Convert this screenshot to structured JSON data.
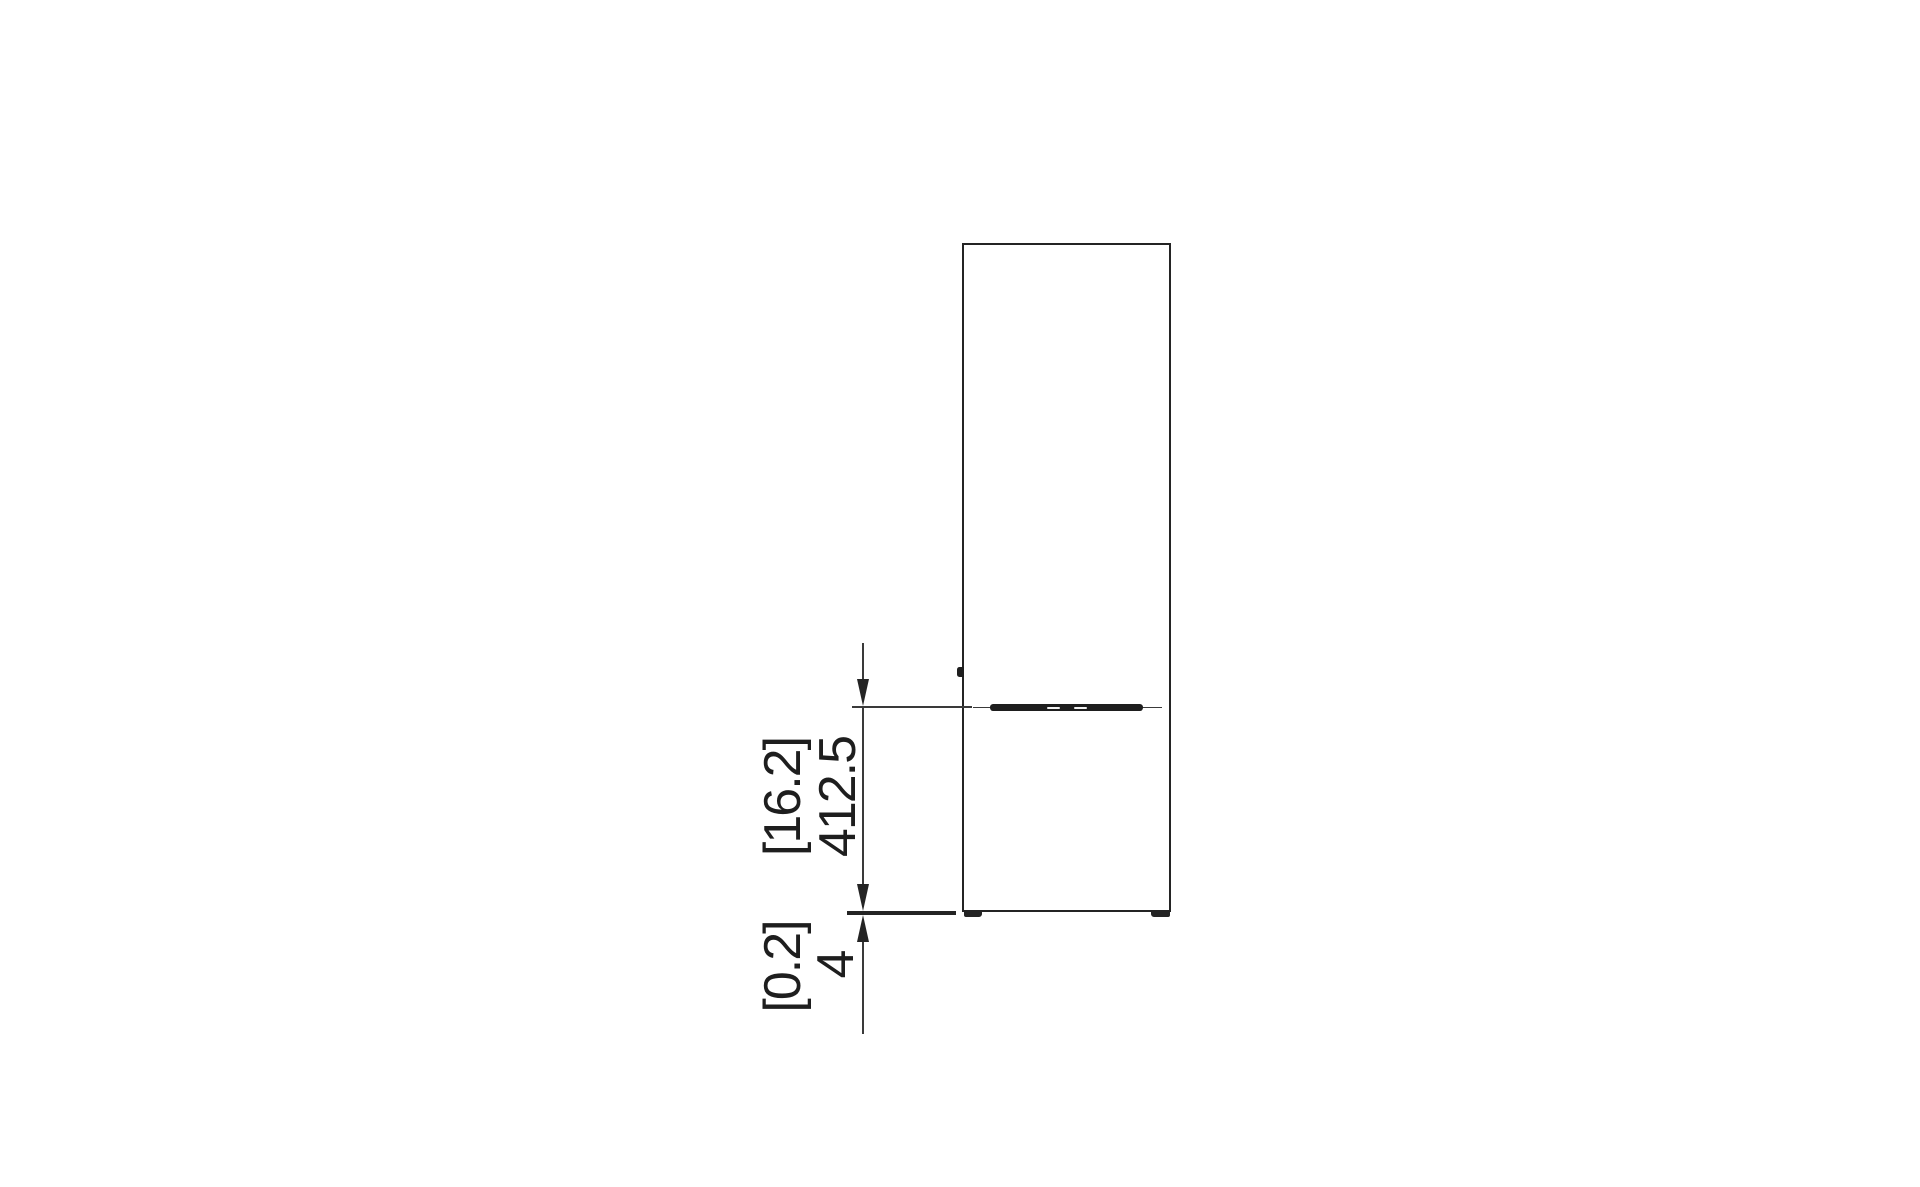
{
  "drawing": {
    "labels": {
      "height_dim_imperial": "[16.2]",
      "height_dim_metric": "412.5",
      "clearance_dim_imperial": "[0.2]",
      "clearance_dim_metric": "4"
    },
    "colors": {
      "background": "#ffffff",
      "line": "#242424",
      "text": "#1e1e1e"
    }
  }
}
